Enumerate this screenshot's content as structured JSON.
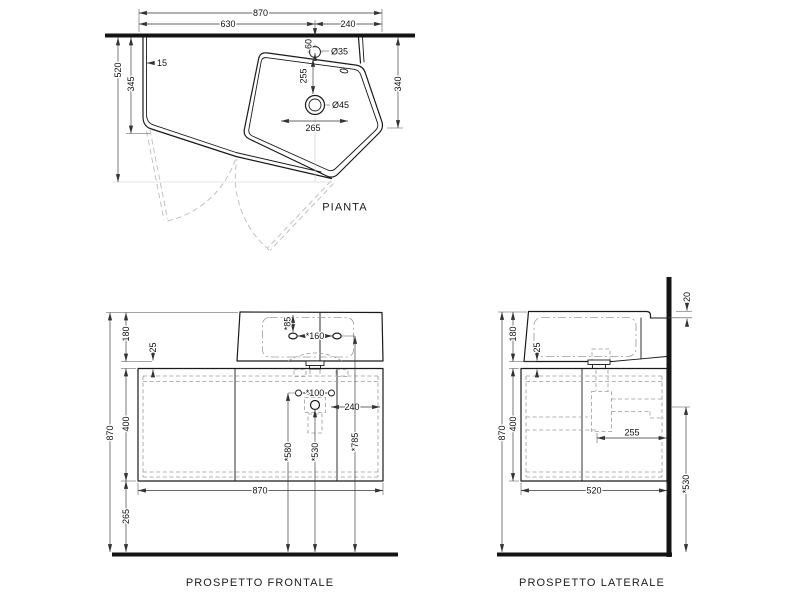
{
  "plan": {
    "title": "PIANTA",
    "width_total": "870",
    "width_left": "630",
    "width_right": "240",
    "depth_total": "520",
    "depth_front_corner": "345",
    "side_gap": "15",
    "depth_right": "340",
    "faucet_wall_offset": "60",
    "faucet_hole": "Ø35",
    "faucet_to_drain": "255",
    "drain_hole": "Ø45",
    "drain_offset": "265"
  },
  "front": {
    "title": "PROSPETTO FRONTALE",
    "height_total": "870",
    "basin_height": "180",
    "gap": "25",
    "cabinet_height": "400",
    "floor_clearance": "265",
    "width_total": "870",
    "hole_depth": "*85",
    "holes_spacing": "*160",
    "mount_spacing": "*100",
    "drain_to_edge": "240",
    "mount_height": "*580",
    "drain_height": "*530",
    "hole_height": "*785"
  },
  "side": {
    "title": "PROSPETTO LATERALE",
    "height_total": "870",
    "basin_height": "180",
    "gap": "25",
    "cabinet_height": "400",
    "depth_total": "520",
    "siphon_depth": "255",
    "drain_height": "*530",
    "ledge_drop": "20"
  }
}
